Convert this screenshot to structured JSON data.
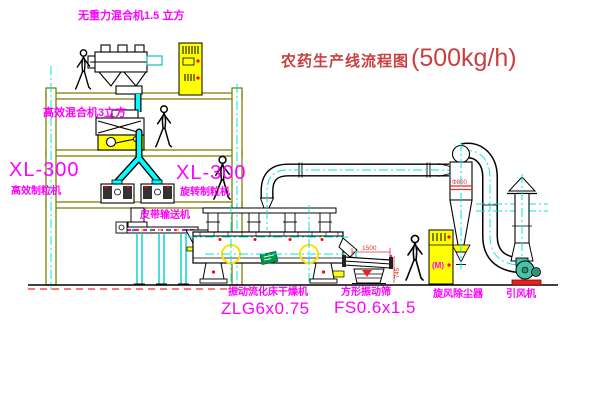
{
  "drawing": {
    "title": {
      "main": "农药生产线流程图",
      "capacity": "(500kg/h)"
    },
    "labels": {
      "gravity_mixer": "无重力混合机1.5 立方",
      "high_efficiency_mixer": "高效混合机3立方",
      "granulator_left_model": "XL-300",
      "granulator_left_name": "高效制粒机",
      "granulator_right_model": "XL-300",
      "granulator_right_name": "旋转制粒机",
      "belt_conveyor": "皮带输送机",
      "dryer_name": "振动流化床干燥机",
      "dryer_model": "ZLG6x0.75",
      "sieve_name": "方形振动筛",
      "sieve_model": "FS0.6x1.5",
      "cyclone": "旋风除尘器",
      "induced_draft_fan": "引风机"
    },
    "dimensions": {
      "sieve_length": "1500",
      "sieve_height": "745",
      "cyclone_diameter": "Φ800"
    },
    "symbols": {
      "motor": "(M)"
    },
    "colors": {
      "label_magenta": "#FF00FF",
      "title_red": "#C94040",
      "dimension_red": "#E03030",
      "structure_olive": "#808000",
      "centerline_cyan": "#00E5E5",
      "cabinet_yellow": "#FFFF00",
      "fan_green": "#49C2A5",
      "logo_green": "#009A44",
      "belt_magenta": "#FF00D0",
      "line_black": "#000000"
    }
  }
}
